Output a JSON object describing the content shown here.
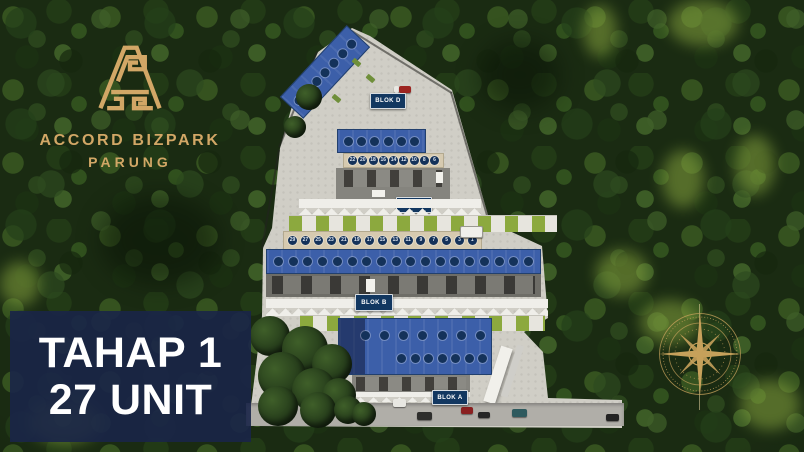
{
  "brand": {
    "line1": "ACCORD BIZPARK",
    "line2": "PARUNG",
    "logo_icon": "accord-monogram-icon"
  },
  "banner": {
    "line1": "TAHAP 1",
    "line2": "27 UNIT"
  },
  "site": {
    "blocks": {
      "d": {
        "label": "BLOK D",
        "roof_badges": [
          "",
          "",
          "",
          "",
          "",
          "",
          ""
        ]
      },
      "c": {
        "label": "BLOK C",
        "roof_badges": [
          "",
          "",
          "",
          "",
          "",
          ""
        ],
        "fascia_units": [
          "22",
          "20",
          "18",
          "16",
          "14",
          "12",
          "10",
          "8",
          "6"
        ]
      },
      "b": {
        "label": "BLOK B",
        "roof_badges": [
          "",
          "",
          "",
          "",
          "",
          "",
          "",
          "",
          "",
          "",
          "",
          "",
          "",
          "",
          "",
          "",
          "",
          ""
        ]
      },
      "a": {
        "label": "BLOK A",
        "roof_row1": [
          "",
          "",
          "",
          "",
          "",
          "",
          ""
        ],
        "roof_row2": [
          "",
          "",
          "",
          "",
          "",
          "",
          ""
        ]
      }
    },
    "mid_row_units": [
      "29",
      "27",
      "25",
      "23",
      "21",
      "19",
      "17",
      "15",
      "13",
      "11",
      "9",
      "7",
      "5",
      "3",
      "1"
    ]
  },
  "icons": {
    "compass": "compass-rose-icon"
  },
  "colors": {
    "gold": "#d2a766",
    "roof_blue": "#3c5fa9",
    "badge_navy": "#14325a",
    "sign_navy": "#123760",
    "banner_navy": "#192548",
    "paved": "#d0cec6",
    "grass_green": "#8ca93e",
    "forest_green": "#1a2b12"
  }
}
